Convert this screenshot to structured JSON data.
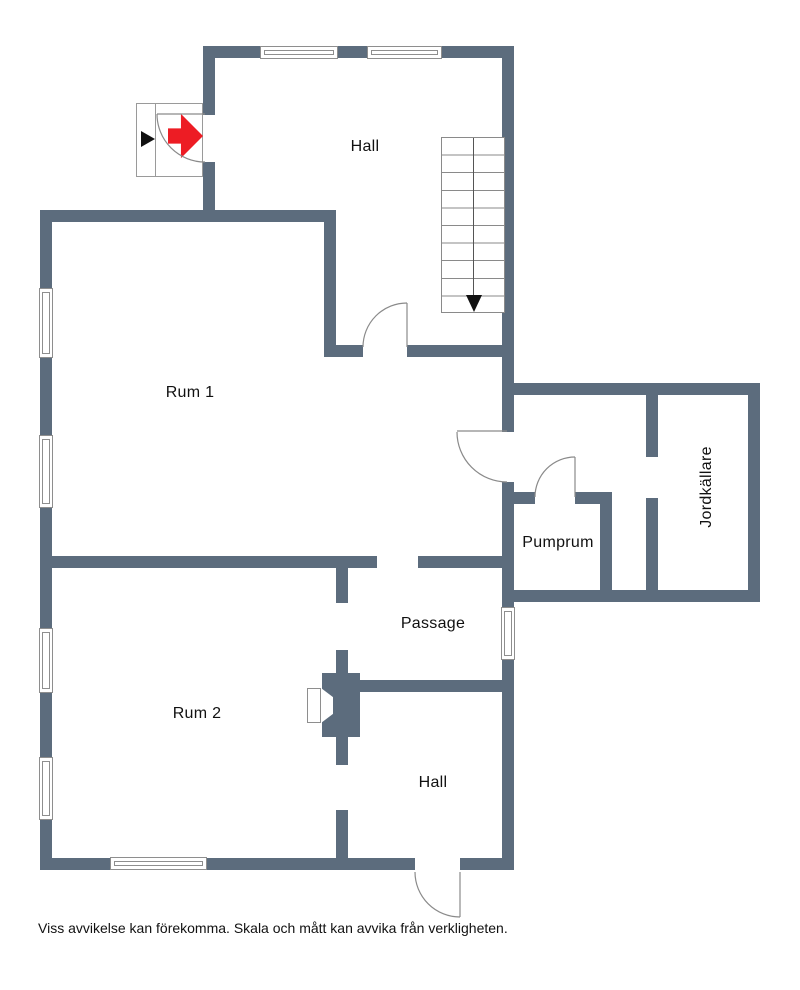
{
  "labels": {
    "hall_top": "Hall",
    "rum1": "Rum 1",
    "rum2": "Rum 2",
    "passage": "Passage",
    "pumprum": "Pumprum",
    "jordkallare": "Jordkällare",
    "hall_bottom": "Hall"
  },
  "footer": {
    "disclaimer": "Viss avvikelse kan förekomma. Skala och mått kan avvika från verkligheten."
  },
  "icons": {
    "entrance_arrow": "red-right-arrow",
    "entrance_marker": "black-right-triangle",
    "stairs_direction": "black-down-arrow"
  },
  "colors": {
    "wall": "#5c6c7d",
    "entrance_arrow_red": "#ed1c24",
    "outline_gray": "#8a8a8a"
  }
}
